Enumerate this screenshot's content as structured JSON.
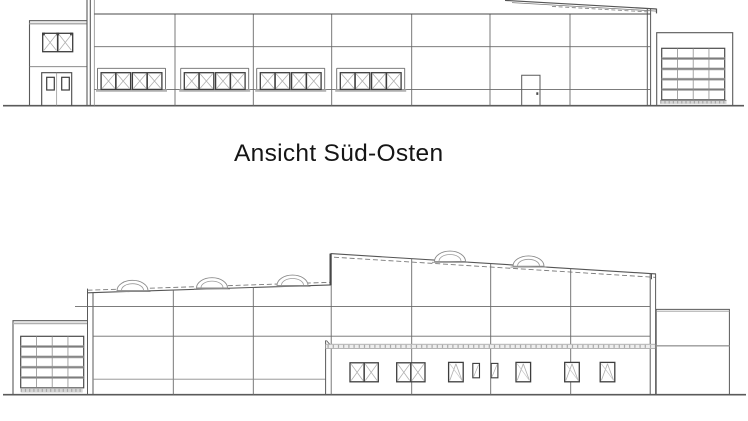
{
  "canvas": {
    "width": 748,
    "height": 421,
    "background": "#ffffff"
  },
  "title": {
    "text": "Ansicht Süd-Osten"
  },
  "colors": {
    "line_dark": "#3d3d3d",
    "line_medium": "#6a6a6a",
    "line_light": "#9e9e9e",
    "sill_band": "#b3b3b3",
    "text": "#151515"
  },
  "elevations": {
    "upper": {
      "position": "above title, cropped at top edge",
      "window_groups": 4,
      "sashes_per_group": 4,
      "annex_windows": 1,
      "doors": 2,
      "sectional_gates": 1,
      "roof": "mono-pitch edge sloping down to the right corner"
    },
    "lower": {
      "position": "below title",
      "skylight_domes": 5,
      "sectional_gates": 1,
      "front_wing_windows": 8,
      "roof": "low hall left, taller hall right, both with dashed parapet lines"
    }
  }
}
